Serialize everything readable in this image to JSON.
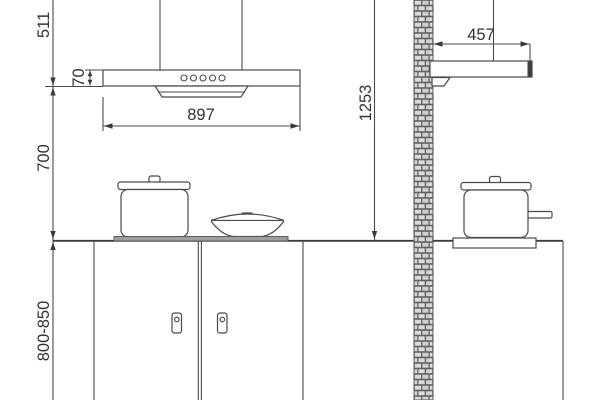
{
  "diagram": {
    "type": "technical-installation-drawing",
    "views": {
      "front": {
        "labels": {
          "chimney_height": "511",
          "hood_body_height": "70",
          "hood_width": "897",
          "hood_to_counter": "700",
          "counter_height": "800-850"
        }
      },
      "side": {
        "labels": {
          "hood_depth": "457",
          "counter_to_ceiling": "1253"
        }
      }
    },
    "colors": {
      "background": "#ffffff",
      "line": "#4a4a4a",
      "text": "#333333",
      "hob_fill": "#9e9e9e",
      "hood_front_edge": "#3f3f3f",
      "brick_fill": "#dcdcdc",
      "brick_mortar": "#f4f4f4",
      "brick_stroke": "#636363"
    }
  }
}
